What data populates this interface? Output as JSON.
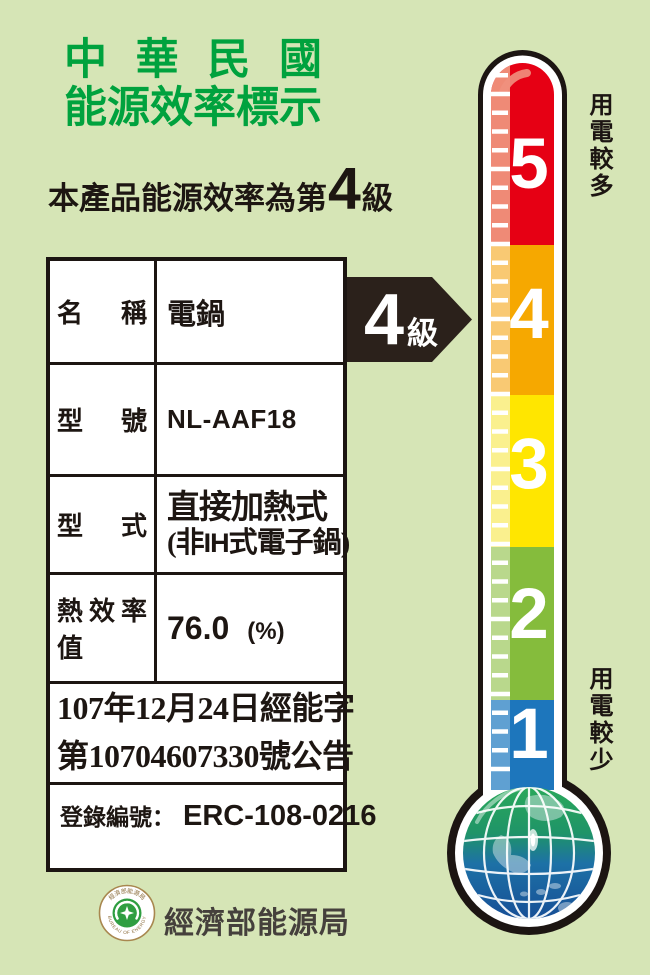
{
  "label": {
    "bg_color": "#d6e5b6",
    "title_line1": "中華民國",
    "title_line2": "能源效率標示",
    "title_color": "#00a23e"
  },
  "subtitle": {
    "prefix": "本產品能源效率為第",
    "grade": "4",
    "suffix": "級"
  },
  "table": {
    "rows": [
      {
        "label": "名稱",
        "value": "電鍋"
      },
      {
        "label": "型號",
        "value": "NL-AAF18"
      },
      {
        "label": "型式",
        "value_line1": "直接加熱式",
        "value_paren_open": "(非",
        "value_ih": "IH",
        "value_paren_rest": "式電子鍋)"
      },
      {
        "label": "熱效率值",
        "value": "76.0",
        "unit": "(%)"
      }
    ],
    "announcement": {
      "line1": "107年12月24日經能字",
      "line2": "第10704607330號公告"
    },
    "registration": {
      "label": "登錄編號：",
      "value": "ERC-108-0216"
    }
  },
  "grade_arrow": {
    "number": "4",
    "suffix": "級",
    "color": "#2b211b"
  },
  "thermometer": {
    "levels": [
      {
        "label": "5",
        "color": "#e60014",
        "tint": "#ef8a76"
      },
      {
        "label": "4",
        "color": "#f6a800",
        "tint": "#f9c973"
      },
      {
        "label": "3",
        "color": "#ffe600",
        "tint": "#faf08e"
      },
      {
        "label": "2",
        "color": "#85bc3c",
        "tint": "#b9d88c"
      },
      {
        "label": "1",
        "color": "#1d76bc",
        "tint": "#5fa0d2"
      }
    ],
    "annotation_top": "用電較多",
    "annotation_bottom": "用電較少"
  },
  "footer": {
    "agency": "經濟部能源局",
    "seal_text_top": "經濟部能源局",
    "seal_text_bottom": "BUREAU OF ENERGY"
  }
}
